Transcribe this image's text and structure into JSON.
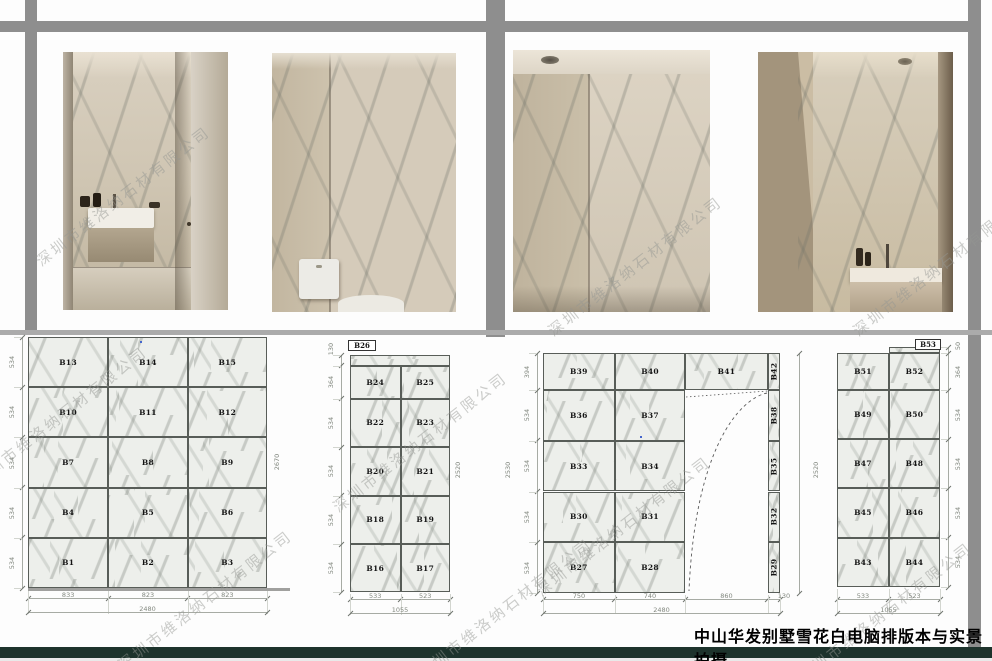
{
  "watermark": "深圳市维洛纳石材有限公司",
  "title": "中山华发别墅雪花白电脑排版本与实景拍摄",
  "diagrams": [
    {
      "name": "wall-layout-1",
      "panel_rows": [
        [
          "B13",
          "B14",
          "B15"
        ],
        [
          "B10",
          "B11",
          "B12"
        ],
        [
          "B7",
          "B8",
          "B9"
        ],
        [
          "B4",
          "B5",
          "B6"
        ],
        [
          "B1",
          "B2",
          "B3"
        ]
      ],
      "row_heights": [
        "534",
        "534",
        "534",
        "534",
        "534"
      ],
      "col_widths": [
        "833",
        "823",
        "823"
      ],
      "width_total": "2480",
      "height_total": "2670"
    },
    {
      "name": "wall-layout-2",
      "strip": {
        "label": "B26",
        "height": "130"
      },
      "panel_rows": [
        [
          "B24",
          "B25"
        ],
        [
          "B22",
          "B23"
        ],
        [
          "B20",
          "B21"
        ],
        [
          "B18",
          "B19"
        ],
        [
          "B16",
          "B17"
        ]
      ],
      "row_heights": [
        "364",
        "534",
        "534",
        "534",
        "534"
      ],
      "col_widths": [
        "533",
        "523"
      ],
      "width_total": "1055",
      "height_total": "2520"
    },
    {
      "name": "wall-layout-3",
      "top_row": [
        "B39",
        "B40",
        "B41",
        "B42"
      ],
      "panel_rows": [
        [
          "B36",
          "B37",
          "B38"
        ],
        [
          "B33",
          "B34",
          "B35"
        ],
        [
          "B30",
          "B31",
          "B32"
        ],
        [
          "B27",
          "B28",
          "B29"
        ]
      ],
      "row_heights": [
        "394",
        "534",
        "534",
        "534",
        "534"
      ],
      "col_widths": [
        "750",
        "740",
        "860",
        "130"
      ],
      "width_total": "2480",
      "height_total_left": "2530",
      "height_total_right": "2520"
    },
    {
      "name": "wall-layout-4",
      "strip": {
        "label": "B53",
        "height": "50"
      },
      "panel_rows": [
        [
          "B51",
          "B52"
        ],
        [
          "B49",
          "B50"
        ],
        [
          "B47",
          "B48"
        ],
        [
          "B45",
          "B46"
        ],
        [
          "B43",
          "B44"
        ]
      ],
      "row_heights": [
        "364",
        "534",
        "534",
        "534",
        "534"
      ],
      "col_widths": [
        "533",
        "523"
      ],
      "width_total": "1055"
    }
  ]
}
